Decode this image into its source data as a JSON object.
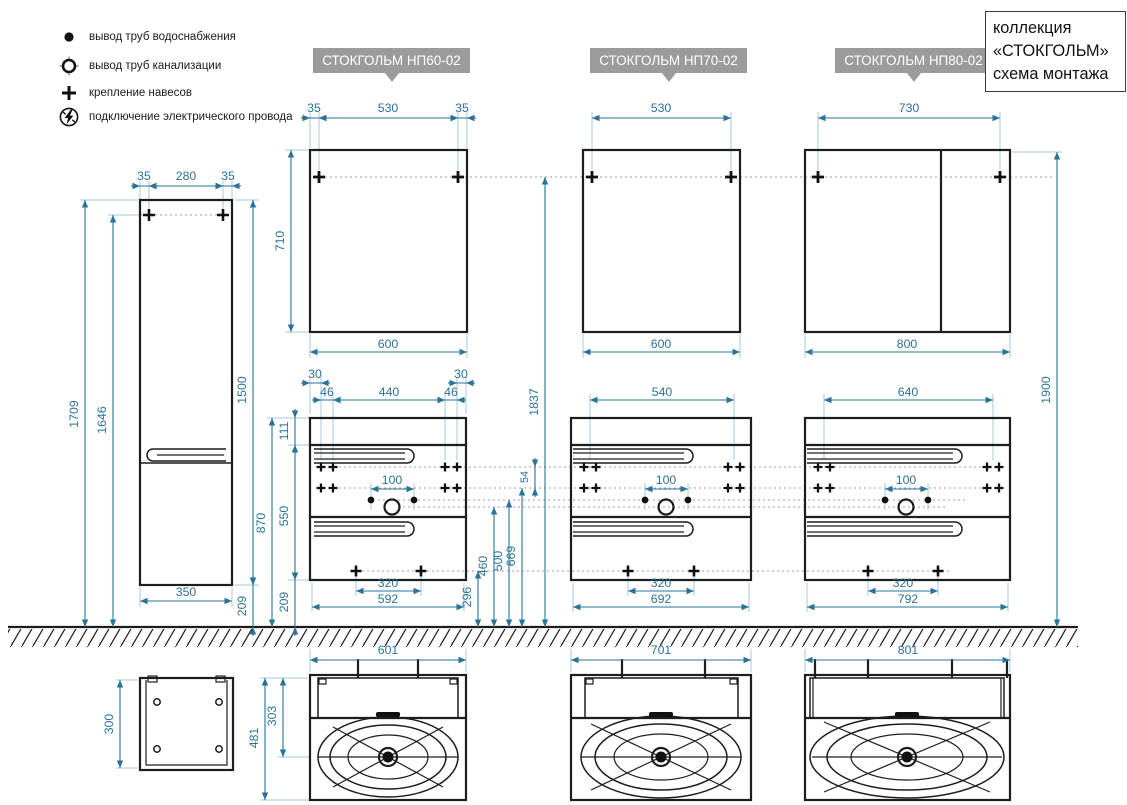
{
  "legend": {
    "items": [
      {
        "icon": "water-supply-icon",
        "label": "вывод труб водоснабжения"
      },
      {
        "icon": "sewage-pipe-icon",
        "label": "вывод труб канализации"
      },
      {
        "icon": "hanger-mount-icon",
        "label": "крепление навесов"
      },
      {
        "icon": "electric-wire-icon",
        "label": "подключение электрического провода"
      }
    ]
  },
  "title_block": {
    "lines": [
      "коллекция",
      "«СТОКГОЛЬМ»",
      "схема монтажа"
    ]
  },
  "products": {
    "np60": "СТОКГОЛЬМ НП60-02",
    "np70": "СТОКГОЛЬМ НП70-02",
    "np80": "СТОКГОЛЬМ НП80-02"
  },
  "colors": {
    "dimension": "#2a7396",
    "extension": "#a9c9db",
    "outline": "#1d1d1d",
    "label_bg": "#9b9b9b",
    "dotted": "#9aa0a4"
  },
  "dims": {
    "tall_top_left": "35",
    "tall_top_center": "280",
    "tall_top_right": "35",
    "tall_total_height": "1709",
    "tall_mount_height": "1646",
    "tall_body_height": "1500",
    "tall_floor_gap": "209",
    "tall_width": "350",
    "tall_depth": "300",
    "m60_offset_left": "35",
    "m60_mount_span": "530",
    "m60_offset_right": "35",
    "m60_height": "710",
    "m60_width": "600",
    "m70_mount_span": "530",
    "m70_width": "600",
    "m80_mount_span": "730",
    "m80_width": "800",
    "mirror_mount_height": "1837",
    "mirror_top_height": "1900",
    "v60_edge_left": "30",
    "v60_bracket_left": "46",
    "v60_mount_span": "440",
    "v60_bracket_right": "46",
    "v60_edge_right": "30",
    "v60_top_band": "111",
    "v60_lower_height": "550",
    "v60_floor_gap": "209",
    "v60_front_height": "870",
    "tap_spacing_60": "100",
    "tap_spacing_70": "100",
    "tap_spacing_80": "100",
    "leg_span_60": "320",
    "leg_span_70": "320",
    "leg_span_80": "320",
    "v60_body_width": "592",
    "v60_width": "601",
    "v70_mount_span": "540",
    "v70_body_width": "692",
    "v70_width": "701",
    "v80_mount_span": "640",
    "v80_body_width": "792",
    "v80_width": "801",
    "bracket_row_gap": "54",
    "legs_height": "296",
    "drain_height": "460",
    "water_height": "500",
    "bracket_height": "669",
    "basin_depth": "481",
    "basin_drain_offset": "303"
  }
}
